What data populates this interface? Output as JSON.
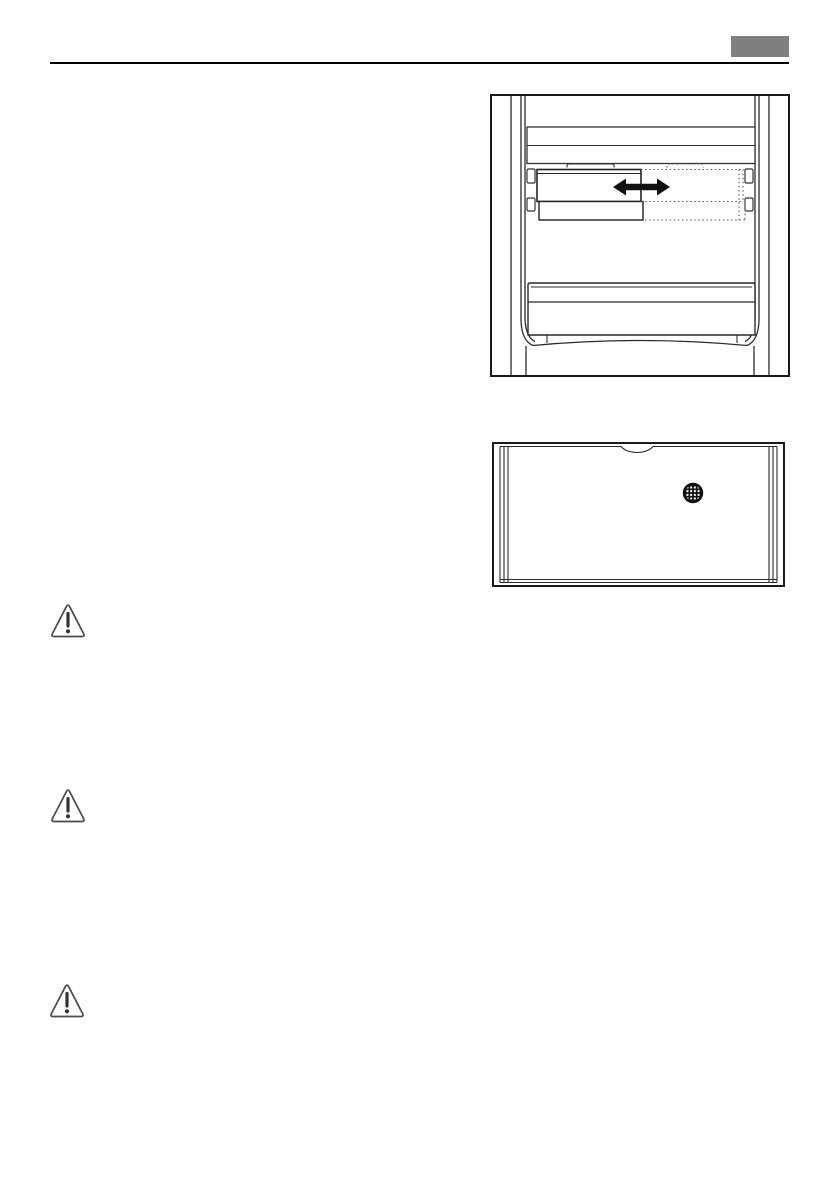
{
  "page": {
    "kind": "appliance manual page (graphics only, no body text)",
    "background": "#ffffff"
  },
  "header": {
    "badge_color": "#7f7f7f",
    "rule_color": "#000000"
  },
  "figures": {
    "sliding_shelf": {
      "label": "refrigerator interior: half-width shelf slides sideways (double-headed arrow shows movement, dotted outline shows alternate position)",
      "stroke_color": "#2a2a2a",
      "arrow_color": "#111111",
      "dotted_color": "#555555"
    },
    "cover_panel": {
      "label": "shelf cover panel with finger notch and round ventilation grille",
      "stroke_color": "#2a2a2a",
      "grille_color": "#111111"
    }
  },
  "warnings": {
    "icon": "warning-triangle-icon",
    "outline_color": "#4a4a4a",
    "glyph_color": "#333333",
    "count": 3
  }
}
